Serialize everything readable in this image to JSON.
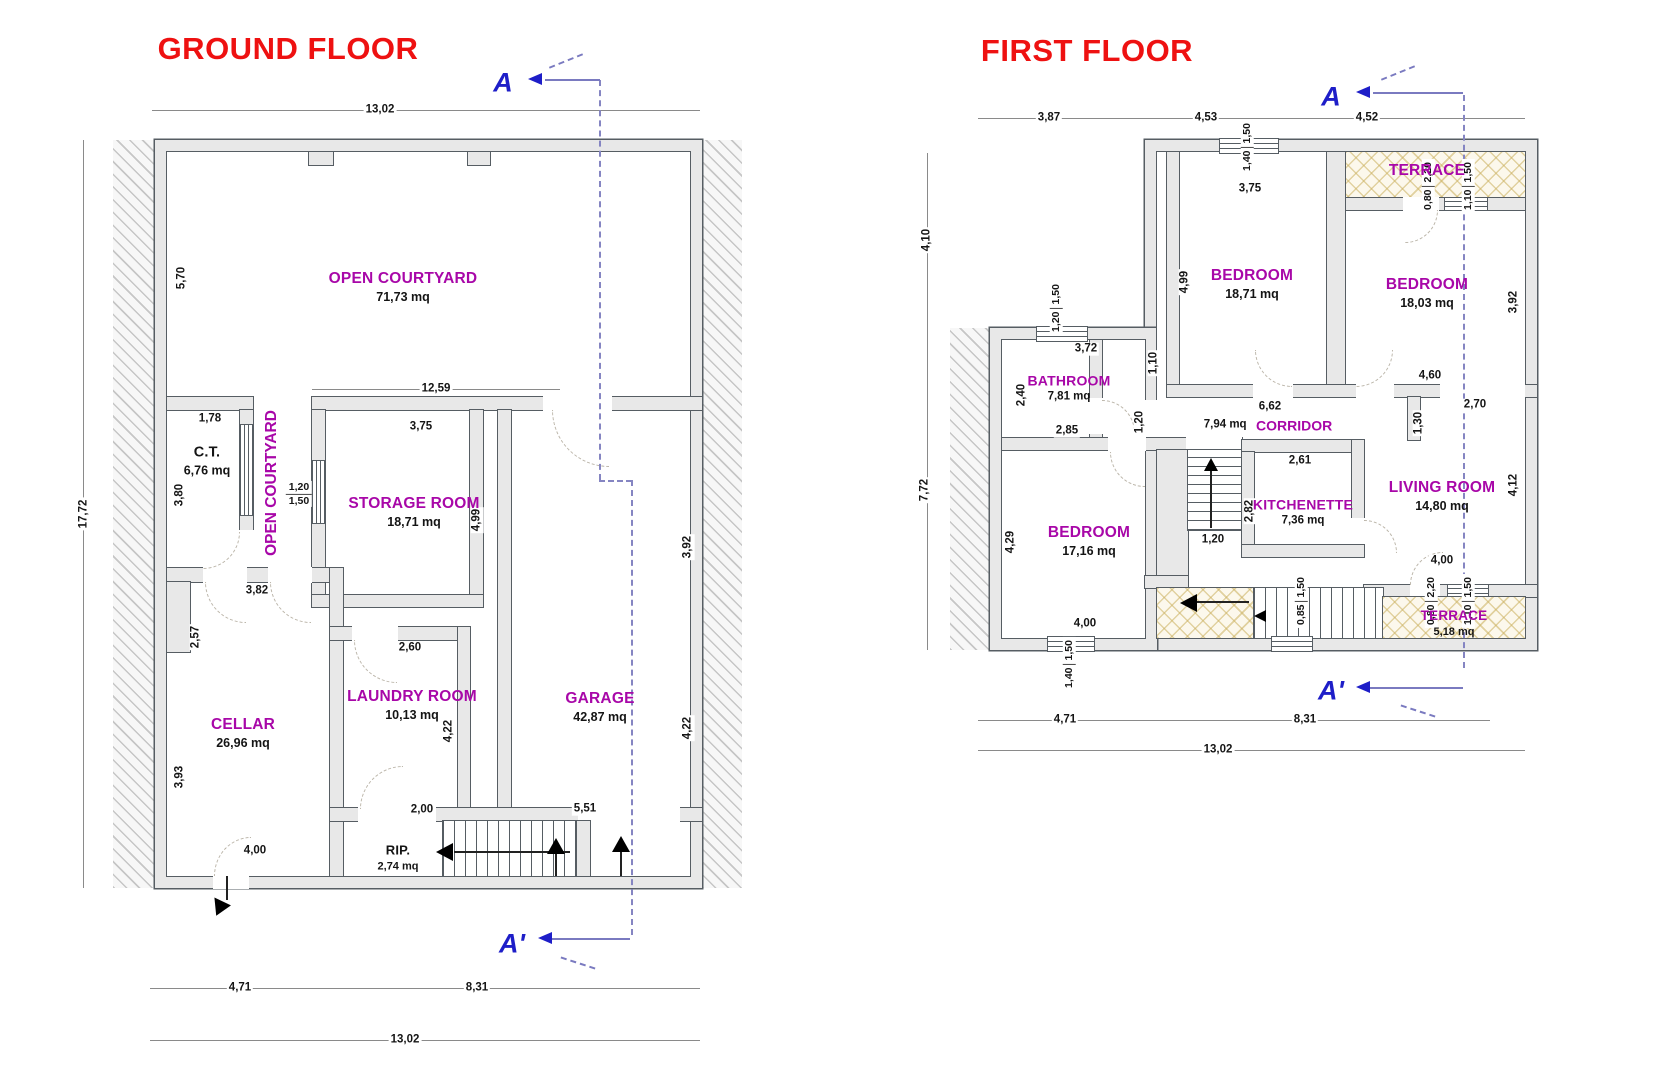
{
  "colors": {
    "title_red": "#ee1111",
    "room_purple": "#a807a8",
    "marker_blue": "#1e1ec8",
    "dim_text": "#151515",
    "wall_fill": "#e8e8e8",
    "wall_line": "#565d63",
    "terrace_tan": "#cbb160"
  },
  "section_markers": {
    "a": "A",
    "a_prime": "A'"
  },
  "ground_floor": {
    "title": "GROUND FLOOR",
    "rooms": {
      "open_courtyard": {
        "name": "OPEN COURTYARD",
        "area": "71,73 mq"
      },
      "open_courtyard_vertical": "OPEN COURTYARD",
      "ct": {
        "name": "C.T.",
        "area": "6,76 mq"
      },
      "storage": {
        "name": "STORAGE ROOM",
        "area": "18,71 mq"
      },
      "cellar": {
        "name": "CELLAR",
        "area": "26,96 mq"
      },
      "laundry": {
        "name": "LAUNDRY ROOM",
        "area": "10,13 mq"
      },
      "garage": {
        "name": "GARAGE",
        "area": "42,87 mq"
      },
      "rip": {
        "name": "RIP.",
        "area": "2,74 mq"
      }
    },
    "dims": {
      "total_width_top": "13,02",
      "total_height": "17,72",
      "courtyard_height": "5,70",
      "courtyard_width": "12,59",
      "ct_width": "1,78",
      "ct_height": "3,80",
      "storage_width": "3,75",
      "storage_height": "4,99",
      "storage_window_w": "1,20",
      "storage_window_h": "1,50",
      "cellar_top": "3,82",
      "cellar_upper": "2,57",
      "cellar_lower": "3,93",
      "cellar_width": "4,00",
      "laundry_width": "2,60",
      "laundry_height": "4,22",
      "laundry_opening": "2,00",
      "garage_upper": "3,92",
      "garage_lower": "4,22",
      "garage_width": "5,51",
      "bottom_left": "4,71",
      "bottom_right": "8,31",
      "bottom_total": "13,02"
    }
  },
  "first_floor": {
    "title": "FIRST FLOOR",
    "rooms": {
      "terrace_top": {
        "name": "TERRACE"
      },
      "bedroom_1": {
        "name": "BEDROOM",
        "area": "18,71 mq"
      },
      "bedroom_2": {
        "name": "BEDROOM",
        "area": "18,03 mq"
      },
      "bathroom": {
        "name": "BATHROOM",
        "area": "7,81 mq"
      },
      "corridor": {
        "name": "CORRIDOR",
        "area": "7,94 mq"
      },
      "bedroom_3": {
        "name": "BEDROOM",
        "area": "17,16 mq"
      },
      "kitchenette": {
        "name": "KITCHENETTE",
        "area": "7,36 mq"
      },
      "living_room": {
        "name": "LIVING ROOM",
        "area": "14,80 mq"
      },
      "terrace_bottom": {
        "name": "TERRACE",
        "area": "5,18 mq"
      }
    },
    "dims": {
      "top_1": "3,87",
      "top_2": "4,53",
      "top_3": "4,52",
      "left_upper": "4,10",
      "left_lower": "7,72",
      "top_window_w": "1,40",
      "top_window_h": "1,50",
      "terrace_top_door_w": "0,80",
      "terrace_top_door_h": "2,20",
      "terrace_top_window_w": "1,10",
      "terrace_top_window_h": "1,50",
      "bedroom1_width": "3,75",
      "bedroom1_height": "4,99",
      "bedroom2_height": "3,92",
      "bedroom2_width": "4,60",
      "bathroom_window_w": "1,20",
      "bathroom_window_h": "1,50",
      "bathroom_width": "3,72",
      "bathroom_height": "2,40",
      "bathroom_bottom": "2,85",
      "bathroom_door": "1,10",
      "corridor_door": "1,20",
      "corridor_length": "6,62",
      "living_top": "2,70",
      "living_nook": "1,30",
      "living_height": "4,12",
      "living_bottom": "4,00",
      "kitchenette_width": "2,61",
      "kitchenette_height": "2,82",
      "stairs_width": "1,20",
      "bedroom3_height": "4,29",
      "bedroom3_width": "4,00",
      "bedroom3_window_w": "1,40",
      "bedroom3_window_h": "1,50",
      "stairs_window_w": "0,85",
      "stairs_window_h": "1,50",
      "terrace_bottom_door_w": "0,80",
      "terrace_bottom_door_h": "2,20",
      "terrace_bottom_window_w": "1,10",
      "terrace_bottom_window_h": "1,50",
      "bottom_left": "4,71",
      "bottom_right": "8,31",
      "bottom_total": "13,02"
    }
  }
}
